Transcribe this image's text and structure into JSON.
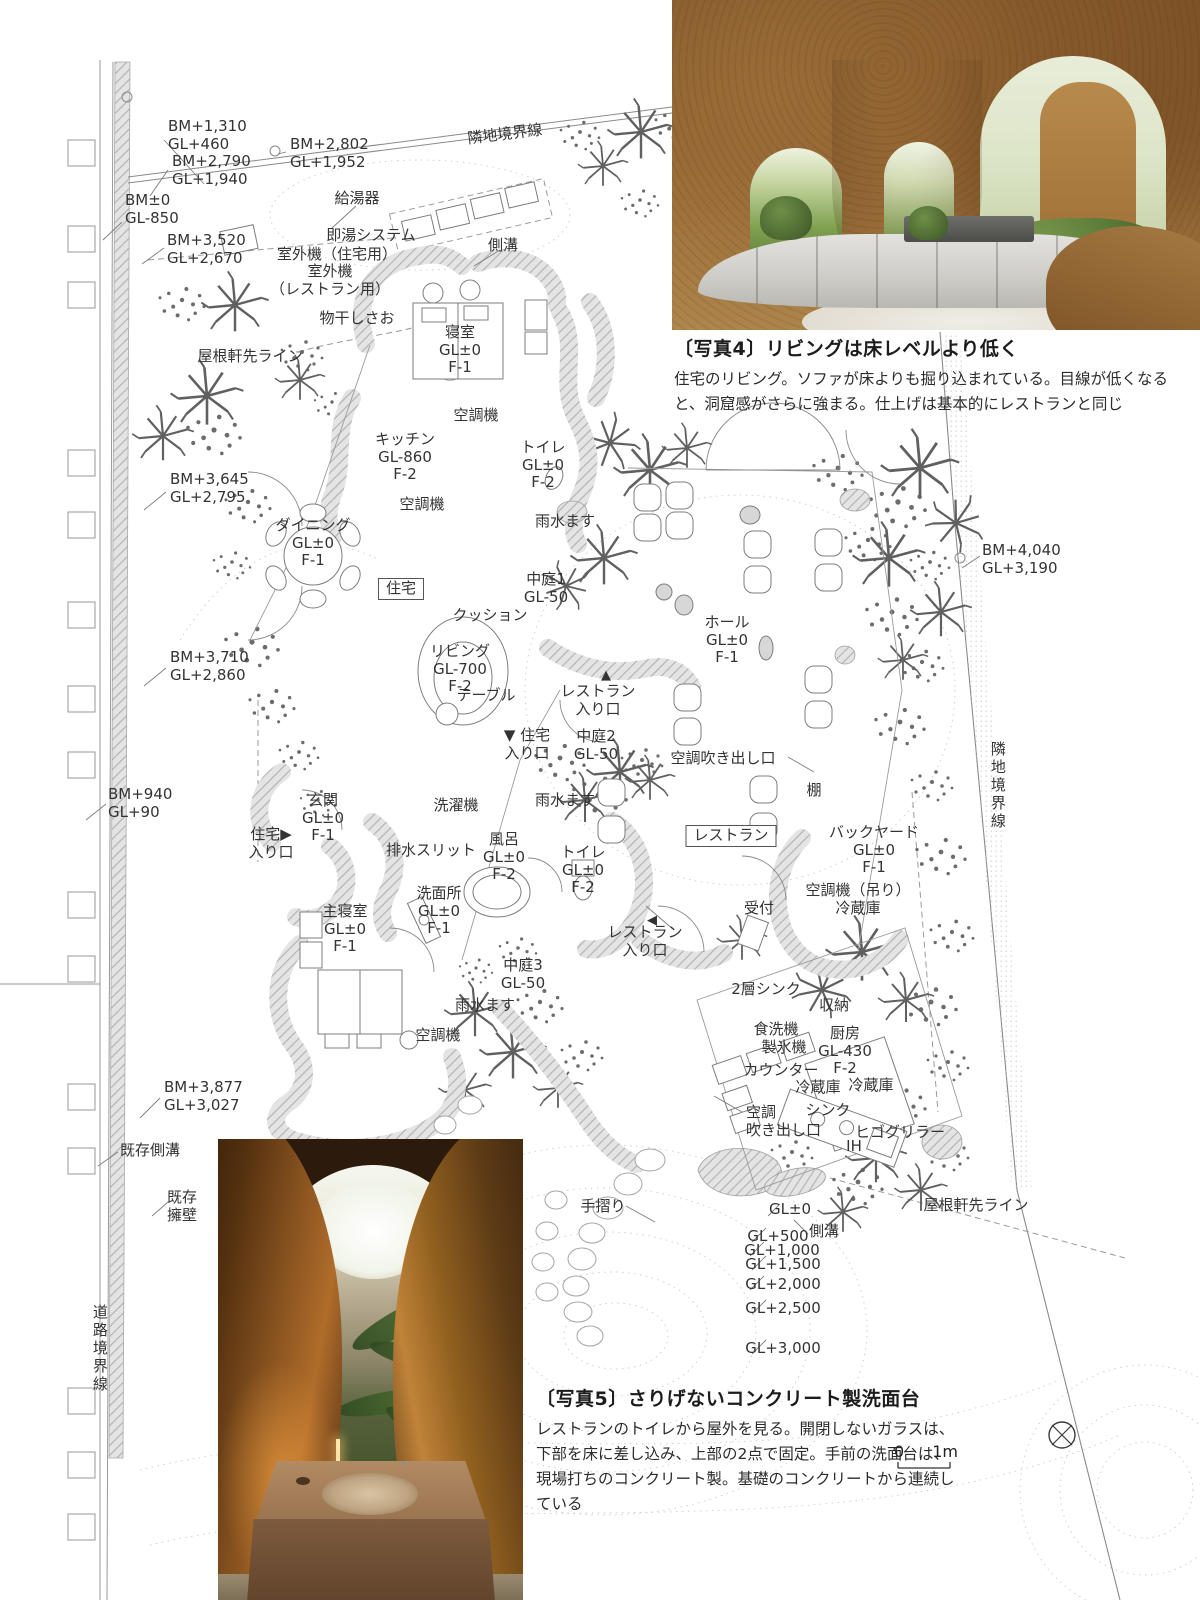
{
  "photo4_caption": {
    "tag": "〔写真4〕",
    "title": "リビングは床レベルより低く",
    "body": "住宅のリビング。ソファが床よりも掘り込まれている。目線が低くなると、洞窟感がさらに強まる。仕上げは基本的にレストランと同じ"
  },
  "photo5_caption": {
    "tag": "〔写真5〕",
    "title": "さりげないコンクリート製洗面台",
    "body": "レストランのトイレから屋外を見る。開閉しないガラスは、下部を床に差し込み、上部の2点で固定。手前の洗面台は、現場打ちのコンクリート製。基礎のコンクリートから連続している"
  },
  "scale": {
    "zero": "0",
    "one": "1m"
  },
  "plan": {
    "labels": [
      {
        "n": "label-bm-1310",
        "t": "BM+1,310\nGL+460",
        "x": 168,
        "y": 118,
        "a": "l"
      },
      {
        "n": "label-bm-2802",
        "t": "BM+2,802\nGL+1,952",
        "x": 290,
        "y": 136,
        "a": "l"
      },
      {
        "n": "label-boundary-top",
        "t": "隣地境界線",
        "x": 505,
        "y": 126,
        "r": -7
      },
      {
        "n": "label-bm-2790",
        "t": "BM+2,790\nGL+1,940",
        "x": 172,
        "y": 153,
        "a": "l"
      },
      {
        "n": "label-bm-0",
        "t": "BM±0\nGL-850",
        "x": 125,
        "y": 192,
        "a": "l"
      },
      {
        "n": "label-bm-3520",
        "t": "BM+3,520\nGL+2,670",
        "x": 167,
        "y": 232,
        "a": "l"
      },
      {
        "n": "label-kyutoki",
        "t": "給湯器",
        "x": 357,
        "y": 190
      },
      {
        "n": "label-sokuyu-system",
        "t": "即湯システム",
        "x": 371,
        "y": 227
      },
      {
        "n": "label-shitsugaiki-jutaku",
        "t": "室外機（住宅用）",
        "x": 337,
        "y": 246
      },
      {
        "n": "label-shitsugaiki-restaurant",
        "t": "室外機\n（レストラン用）",
        "x": 330,
        "y": 263
      },
      {
        "n": "label-monohoshi",
        "t": "物干しさお",
        "x": 357,
        "y": 310
      },
      {
        "n": "label-yane-nokisaki-left",
        "t": "屋根軒先ライン",
        "x": 250,
        "y": 348
      },
      {
        "n": "label-sokko-top",
        "t": "側溝",
        "x": 503,
        "y": 237
      },
      {
        "n": "label-shinshitsu",
        "t": "寝室\nGL±0\nF-1",
        "x": 460,
        "y": 324
      },
      {
        "n": "label-kuchoki-bedroom",
        "t": "空調機",
        "x": 476,
        "y": 407
      },
      {
        "n": "label-kitchen",
        "t": "キッチン\nGL-860\nF-2",
        "x": 405,
        "y": 431
      },
      {
        "n": "label-toilet-north",
        "t": "トイレ\nGL±0\nF-2",
        "x": 543,
        "y": 439
      },
      {
        "n": "label-kuchoki-kitchen",
        "t": "空調機",
        "x": 422,
        "y": 496
      },
      {
        "n": "label-usui-1",
        "t": "雨水ます",
        "x": 565,
        "y": 513
      },
      {
        "n": "label-dining",
        "t": "ダイニング\nGL±0\nF-1",
        "x": 313,
        "y": 517
      },
      {
        "n": "label-nakaniwa-1",
        "t": "中庭1\nGL-50",
        "x": 546,
        "y": 571
      },
      {
        "n": "label-jutaku",
        "t": "住宅",
        "x": 401,
        "y": 578,
        "box": true
      },
      {
        "n": "label-cushion",
        "t": "クッション",
        "x": 490,
        "y": 607
      },
      {
        "n": "label-hall",
        "t": "ホール\nGL±0\nF-1",
        "x": 727,
        "y": 614
      },
      {
        "n": "label-living",
        "t": "リビング\nGL-700\nF-2",
        "x": 460,
        "y": 643
      },
      {
        "n": "label-bm-3645",
        "t": "BM+3,645\nGL+2,795",
        "x": 170,
        "y": 471,
        "a": "l"
      },
      {
        "n": "label-bm-3710",
        "t": "BM+3,710\nGL+2,860",
        "x": 170,
        "y": 649,
        "a": "l"
      },
      {
        "n": "label-table",
        "t": "テーブル",
        "x": 486,
        "y": 687
      },
      {
        "n": "label-bm-4040",
        "t": "BM+4,040\nGL+3,190",
        "x": 982,
        "y": 542,
        "a": "l"
      },
      {
        "n": "label-resto-entrance-marker-1",
        "t": "▲",
        "x": 606,
        "y": 668,
        "fs": 13
      },
      {
        "n": "label-resto-entrance-1",
        "t": "レストラン\n入り口",
        "x": 598,
        "y": 683
      },
      {
        "n": "label-jutaku-entrance-1",
        "t": "▼ 住宅\n入り口",
        "x": 527,
        "y": 727
      },
      {
        "n": "label-nakaniwa-2",
        "t": "中庭2\nGL-50",
        "x": 596,
        "y": 728
      },
      {
        "n": "label-kucho-fukidashi-1",
        "t": "空調吹き出し口",
        "x": 723,
        "y": 750
      },
      {
        "n": "label-tana",
        "t": "棚",
        "x": 814,
        "y": 782
      },
      {
        "n": "label-usui-2",
        "t": "雨水ます",
        "x": 565,
        "y": 792
      },
      {
        "n": "label-bm-940",
        "t": "BM+940\nGL+90",
        "x": 108,
        "y": 786,
        "a": "l"
      },
      {
        "n": "label-genkan",
        "t": "玄関\nGL±0\nF-1",
        "x": 323,
        "y": 792
      },
      {
        "n": "label-jutaku-entrance-2",
        "t": "住宅▶\n入り口",
        "x": 271,
        "y": 826
      },
      {
        "n": "label-sentakuki",
        "t": "洗濯機",
        "x": 456,
        "y": 797
      },
      {
        "n": "label-backyard",
        "t": "バックヤード\nGL±0\nF-1",
        "x": 874,
        "y": 824
      },
      {
        "n": "label-restaurant",
        "t": "レストラン",
        "x": 731,
        "y": 825,
        "box": true
      },
      {
        "n": "label-haisui-slit",
        "t": "排水スリット",
        "x": 431,
        "y": 842
      },
      {
        "n": "label-furo",
        "t": "風呂\nGL±0\nF-2",
        "x": 504,
        "y": 831
      },
      {
        "n": "label-toilet-center",
        "t": "トイレ\nGL±0\nF-2",
        "x": 583,
        "y": 844
      },
      {
        "n": "label-kuchoki-tsuri",
        "t": "空調機（吊り）\n冷蔵庫",
        "x": 858,
        "y": 882
      },
      {
        "n": "label-uketsuke",
        "t": "受付",
        "x": 759,
        "y": 900
      },
      {
        "n": "label-shushinshitsu",
        "t": "主寝室\nGL±0\nF-1",
        "x": 345,
        "y": 903
      },
      {
        "n": "label-senmenjo",
        "t": "洗面所\nGL±0\nF-1",
        "x": 439,
        "y": 885
      },
      {
        "n": "label-resto-entrance-marker-2",
        "t": "◀",
        "x": 652,
        "y": 913,
        "fs": 13
      },
      {
        "n": "label-resto-entrance-2",
        "t": "レストラン\n入り口",
        "x": 645,
        "y": 924
      },
      {
        "n": "label-nakaniwa-3",
        "t": "中庭3\nGL-50",
        "x": 523,
        "y": 957
      },
      {
        "n": "label-niso-sink",
        "t": "2層シンク",
        "x": 766,
        "y": 981
      },
      {
        "n": "label-usui-3",
        "t": "雨水ます",
        "x": 485,
        "y": 997
      },
      {
        "n": "label-shuno",
        "t": "収納",
        "x": 834,
        "y": 997
      },
      {
        "n": "label-shokusenki",
        "t": "食洗機",
        "x": 776,
        "y": 1021
      },
      {
        "n": "label-kuchoki-bed2",
        "t": "空調機",
        "x": 438,
        "y": 1027
      },
      {
        "n": "label-seihyoki",
        "t": "製氷機",
        "x": 784,
        "y": 1039
      },
      {
        "n": "label-chubo",
        "t": "厨房\nGL-430\nF-2",
        "x": 845,
        "y": 1025
      },
      {
        "n": "label-counter",
        "t": "カウンター",
        "x": 781,
        "y": 1062
      },
      {
        "n": "label-reizoko-1",
        "t": "冷蔵庫",
        "x": 818,
        "y": 1079
      },
      {
        "n": "label-reizoko-2",
        "t": "冷蔵庫",
        "x": 871,
        "y": 1077
      },
      {
        "n": "label-bm-3877",
        "t": "BM+3,877\nGL+3,027",
        "x": 164,
        "y": 1079,
        "a": "l"
      },
      {
        "n": "label-sink",
        "t": "シンク",
        "x": 828,
        "y": 1102
      },
      {
        "n": "label-kucho-fukidashi-2",
        "t": "空調\n吹き出し口",
        "x": 746,
        "y": 1104,
        "a": "l"
      },
      {
        "n": "label-higo-griller",
        "t": "ヒゴグリラー",
        "x": 900,
        "y": 1124
      },
      {
        "n": "label-ih",
        "t": "IH",
        "x": 854,
        "y": 1138
      },
      {
        "n": "label-kison-sokko",
        "t": "既存側溝",
        "x": 150,
        "y": 1142
      },
      {
        "n": "label-kison-yoheki",
        "t": "既存\n擁壁",
        "x": 182,
        "y": 1189
      },
      {
        "n": "label-tesuri",
        "t": "手摺り",
        "x": 603,
        "y": 1198
      },
      {
        "n": "label-gl-0",
        "t": "GL±0",
        "x": 790,
        "y": 1201
      },
      {
        "n": "label-sokko-bottom",
        "t": "側溝",
        "x": 824,
        "y": 1223
      },
      {
        "n": "label-yane-nokisaki-right",
        "t": "屋根軒先ライン",
        "x": 976,
        "y": 1197
      },
      {
        "n": "label-gl-500",
        "t": "GL+500",
        "x": 778,
        "y": 1228
      },
      {
        "n": "label-gl-1000",
        "t": "GL+1,000",
        "x": 782,
        "y": 1242
      },
      {
        "n": "label-gl-1500",
        "t": "GL+1,500",
        "x": 783,
        "y": 1256
      },
      {
        "n": "label-gl-2000",
        "t": "GL+2,000",
        "x": 783,
        "y": 1276
      },
      {
        "n": "label-gl-2500",
        "t": "GL+2,500",
        "x": 783,
        "y": 1300
      },
      {
        "n": "label-gl-3000",
        "t": "GL+3,000",
        "x": 783,
        "y": 1340
      },
      {
        "n": "label-doro-kyokai",
        "t": "道路境界線",
        "x": 99,
        "y": 1304,
        "v": true
      },
      {
        "n": "label-rinchi-right",
        "t": "隣地境界線",
        "x": 997,
        "y": 741,
        "v": true
      }
    ]
  }
}
